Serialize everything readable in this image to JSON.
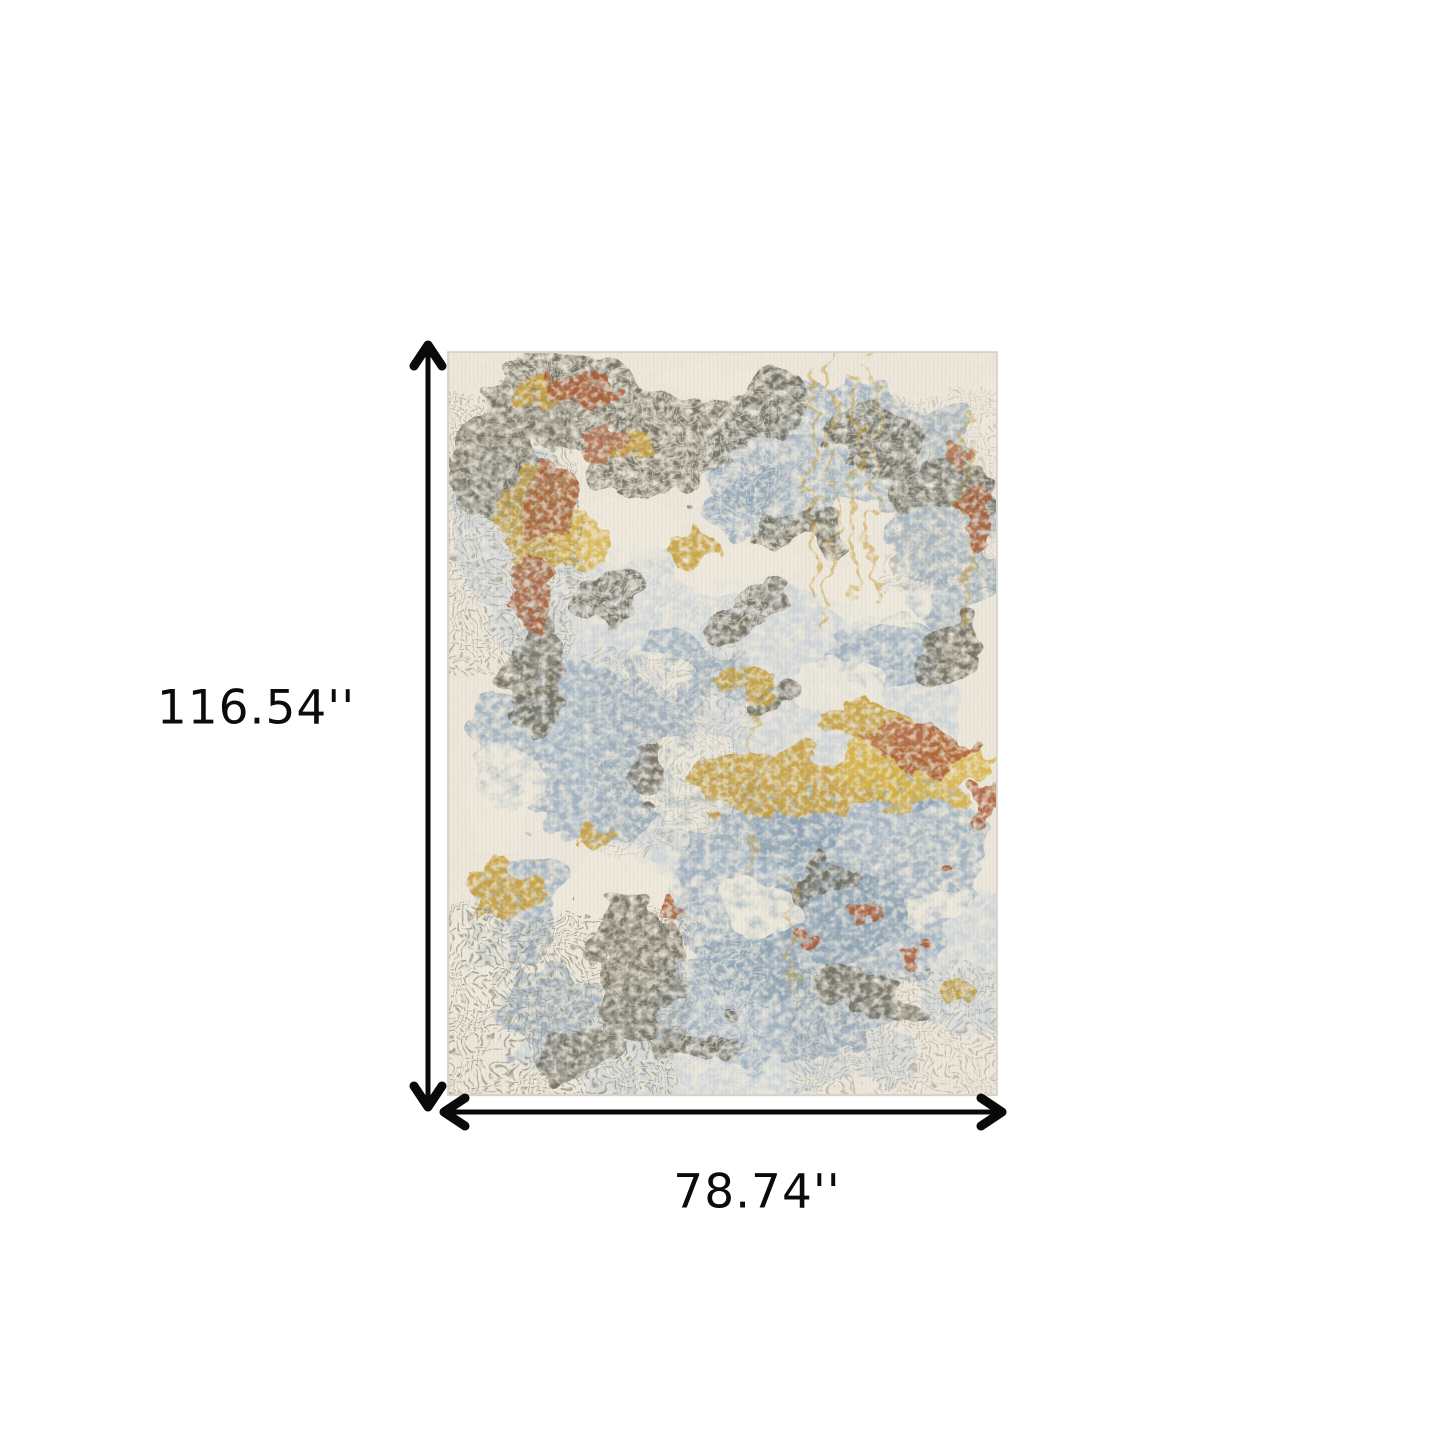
{
  "canvas": {
    "background": "#ffffff"
  },
  "dimension_annotations": {
    "arrow_color": "#0a0a0a",
    "height": {
      "label": "116.54''",
      "orientation": "vertical"
    },
    "width": {
      "label": "78.74''",
      "orientation": "horizontal"
    }
  },
  "rug_swatch": {
    "description": "abstract distressed area rug swatch",
    "palette": {
      "ivory_base": "#ebe6d9",
      "ivory_light": "#efeadd",
      "pale_blue": "#c6d0d9",
      "blue_gray": "#9fb0c0",
      "slate_blue": "#8ba0b2",
      "dark_taupe": "#6f6d5f",
      "warm_gray": "#8e8b7d",
      "gold": "#c8a03c",
      "amber": "#d9b44a",
      "rust": "#ab5f38",
      "copper": "#b5714d"
    }
  }
}
